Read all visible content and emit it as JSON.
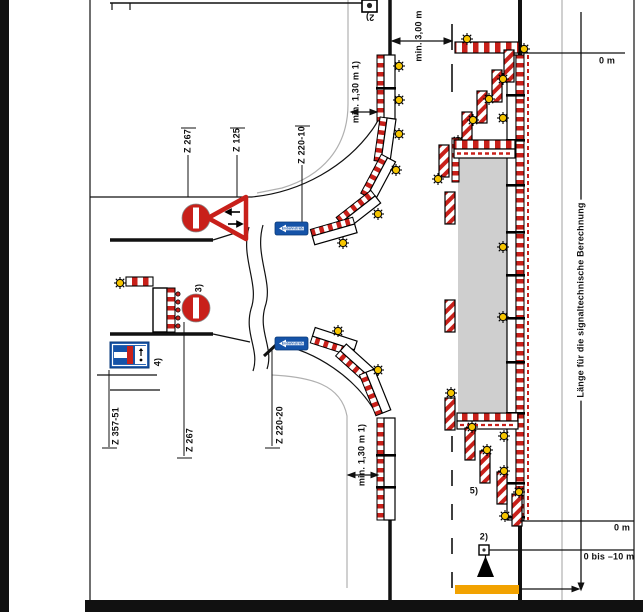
{
  "labels": {
    "z267_top": "Z 267",
    "z125": "Z 125",
    "z220_10": "Z 220-10",
    "z357_51": "Z 357-51",
    "z267_bottom": "Z 267",
    "z220_20": "Z 220-20",
    "note2_top": "2)",
    "note3": "3)",
    "note4": "4)",
    "note5": "5)",
    "note2_bottom": "2)",
    "dim_lane": "min. 3,00 m",
    "dim_walk_top": "min. 1,30 m 1)",
    "dim_walk_bottom": "min. 1,30 m 1)",
    "station_top": "0 m",
    "station_bottom": "0 m",
    "station_signal": "0 bis –10 m",
    "length_note": "Länge für die signaltechnische Berechnung",
    "einbahn_top": "Einbahnstraße",
    "einbahn_bottom": "Einbahnstraße"
  },
  "colors": {
    "barrier_red": "#c8201a",
    "lamp_yellow": "#f6c500",
    "sign_blue": "#1553a8",
    "sign_blue_dark": "#0a3a78",
    "work_gray": "#cfcfcf",
    "stop_yellow": "#f2a200",
    "line_gray": "#b0b0b0",
    "ink": "#111111"
  }
}
